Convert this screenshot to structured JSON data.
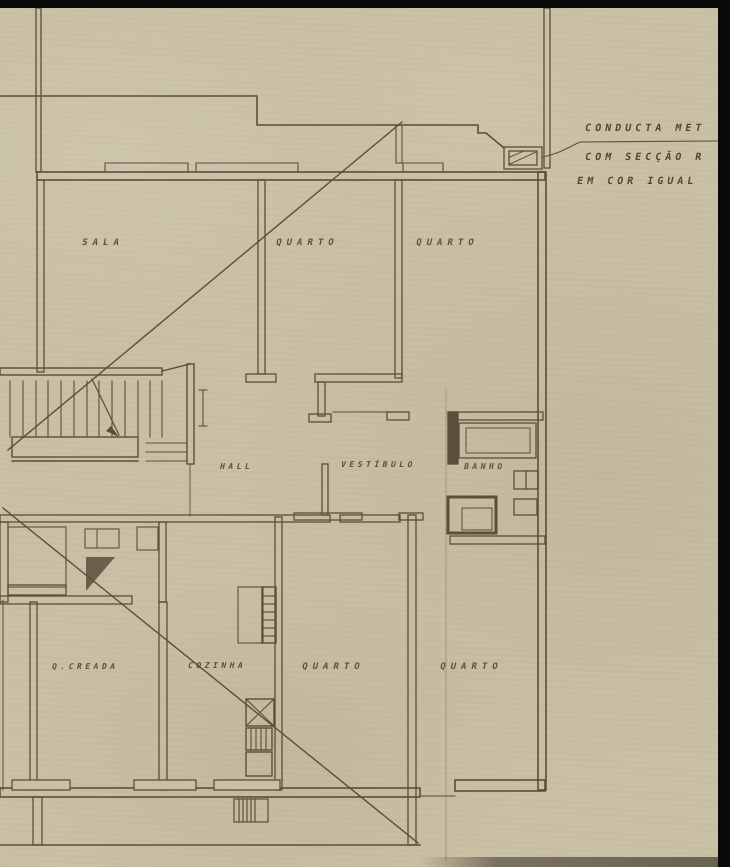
{
  "colors": {
    "paper": "#c9c0a6",
    "ink": "#5c4e3b",
    "frame": "#0a0a0a",
    "label_text": "#554734"
  },
  "rooms": [
    {
      "id": "sala",
      "label": "SALA"
    },
    {
      "id": "quarto-top-1",
      "label": "QUARTO"
    },
    {
      "id": "quarto-top-2",
      "label": "QUARTO"
    },
    {
      "id": "hall",
      "label": "HALL"
    },
    {
      "id": "vestibulo",
      "label": "VESTÍBULO"
    },
    {
      "id": "banho",
      "label": "BANHO"
    },
    {
      "id": "q-creada",
      "label": "Q.CREADA"
    },
    {
      "id": "cozinha",
      "label": "COZINHA"
    },
    {
      "id": "quarto-bottom-1",
      "label": "QUARTO"
    },
    {
      "id": "quarto-bottom-2",
      "label": "QUARTO"
    }
  ],
  "annotation": {
    "line1": "CONDUCTA MET",
    "line2": "COM SECÇÃO R",
    "line3": "EM COR IGUAL"
  }
}
